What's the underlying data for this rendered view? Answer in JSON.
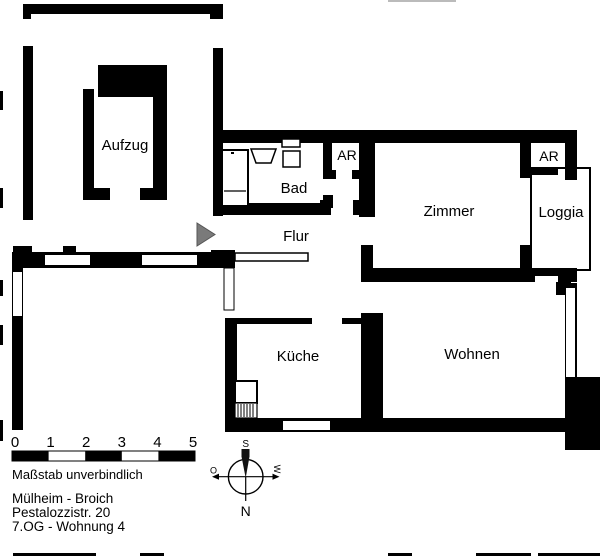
{
  "plan": {
    "room_labels": {
      "aufzug": "Aufzug",
      "bad": "Bad",
      "ar_bad": "AR",
      "zimmer": "Zimmer",
      "ar_loggia": "AR",
      "loggia": "Loggia",
      "flur": "Flur",
      "kueche": "Küche",
      "wohnen": "Wohnen"
    }
  },
  "scale_bar": {
    "ticks": [
      "0",
      "1",
      "2",
      "3",
      "4",
      "5"
    ],
    "note": "Maßstab unverbindlich"
  },
  "address": {
    "location": "Mülheim - Broich",
    "street": "Pestalozzistr. 20",
    "unit": "7.OG - Wohnung 4"
  },
  "compass": {
    "top": "S",
    "right": "W",
    "bottom": "N",
    "left": "O"
  },
  "colors": {
    "wall": "#000000",
    "background": "#ffffff",
    "entrance_marker": "#7a7a7a"
  }
}
